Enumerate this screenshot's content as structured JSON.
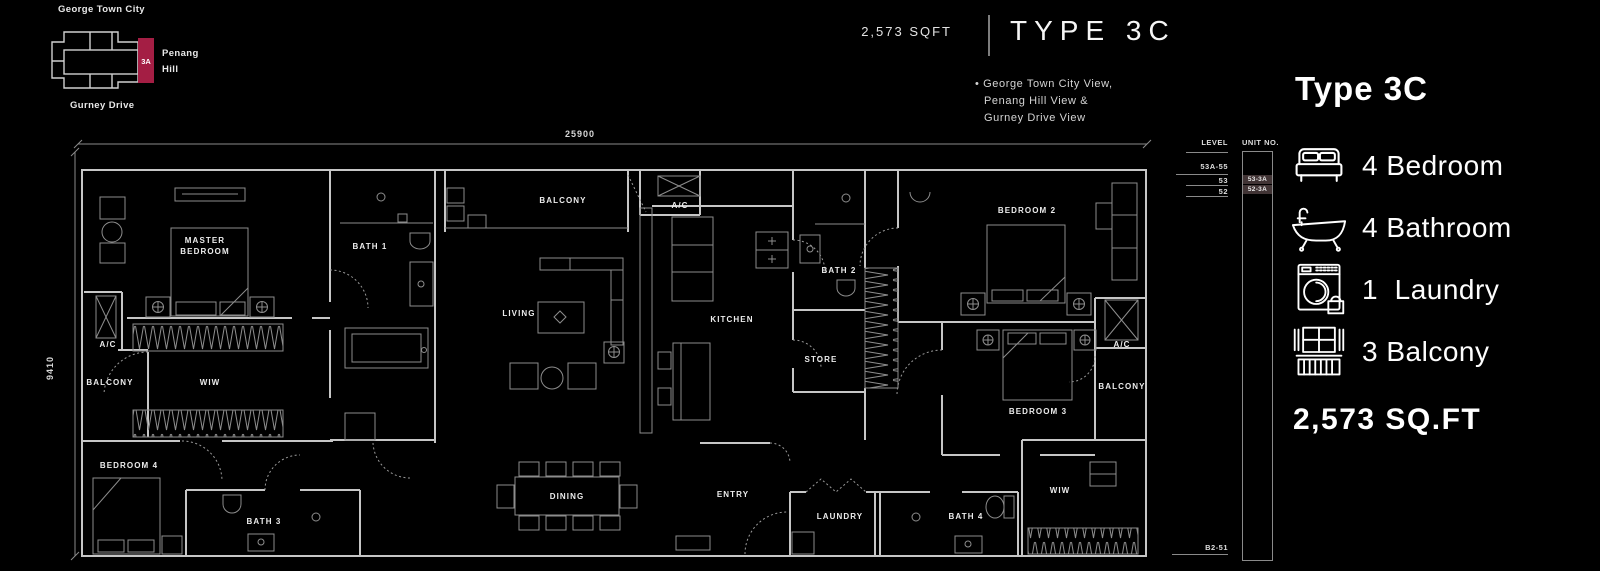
{
  "colors": {
    "accent": "#a41e44",
    "plan_line": "#c6c6c6",
    "highlight_cell": "#413435"
  },
  "key_plan": {
    "city": "George Town City",
    "hill_1": "Penang",
    "hill_2": "Hill",
    "drive": "Gurney Drive",
    "unit": "3A"
  },
  "header": {
    "sqft": "2,573 SQFT",
    "type": "TYPE 3C",
    "views": [
      "• George Town City View,",
      "Penang Hill View &",
      "Gurney Drive View"
    ]
  },
  "floor_plan": {
    "dim_width": "25900",
    "dim_height": "9410",
    "rooms": {
      "master_line1": "MASTER",
      "master_line2": "BEDROOM",
      "bath_1": "BATH 1",
      "balcony_top": "BALCONY",
      "ac_top": "A/C",
      "living": "LIVING",
      "kitchen": "KITCHEN",
      "bath_2": "BATH 2",
      "store": "STORE",
      "bedroom_2": "BEDROOM 2",
      "bedroom_3": "BEDROOM 3",
      "ac_right": "A/C",
      "balcony_right": "BALCONY",
      "ac_left": "A/C",
      "balcony_left": "BALCONY",
      "wiw_left": "WIW",
      "bedroom_4": "BEDROOM 4",
      "bath_3": "BATH 3",
      "dining": "DINING",
      "entry": "ENTRY",
      "laundry": "LAUNDRY",
      "bath_4": "BATH 4",
      "wiw_right": "WIW"
    }
  },
  "level_table": {
    "level_header": "LEVEL",
    "unit_header": "UNIT NO.",
    "levels": [
      "53A-55",
      "53",
      "52"
    ],
    "units": [
      "53-3A",
      "52-3A"
    ],
    "basement": "B2-51"
  },
  "info_panel": {
    "title": "Type 3C",
    "features": [
      {
        "icon": "bed-icon",
        "text": "4 Bedroom"
      },
      {
        "icon": "bathtub-icon",
        "text": "4 Bathroom"
      },
      {
        "icon": "washing-machine-icon",
        "text": "1  Laundry"
      },
      {
        "icon": "balcony-icon",
        "text": "3 Balcony"
      }
    ],
    "area": "2,573 SQ.FT"
  }
}
